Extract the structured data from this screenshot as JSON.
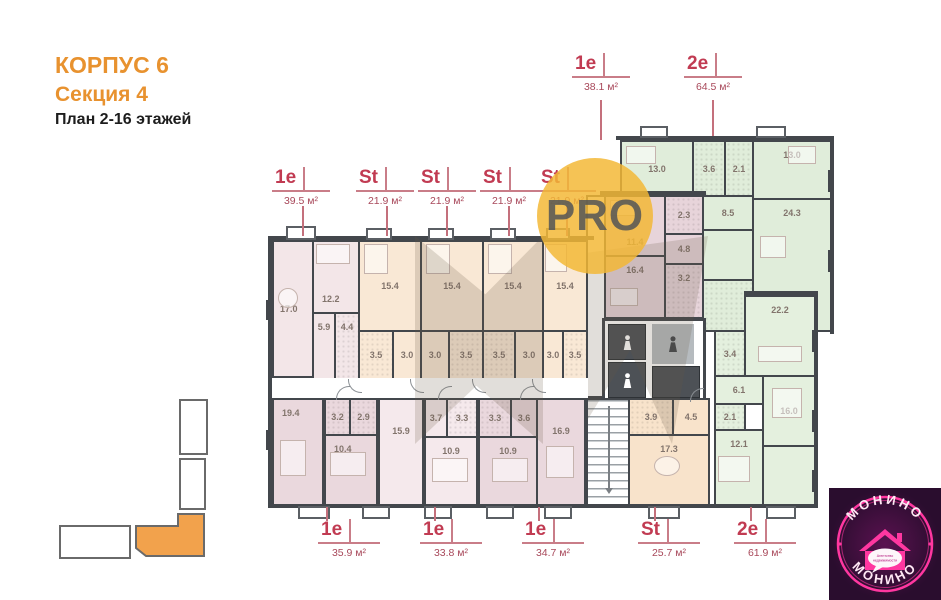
{
  "title": {
    "building": "КОРПУС 6",
    "section": "Секция 4",
    "floors": "План 2-16 этажей"
  },
  "callouts": {
    "top": [
      {
        "type": "1e",
        "area": "38.1 м²"
      },
      {
        "type": "2e",
        "area": "64.5 м²"
      }
    ],
    "upper": [
      {
        "type": "1e",
        "area": "39.5 м²"
      },
      {
        "type": "St",
        "area": "21.9 м²"
      },
      {
        "type": "St",
        "area": "21.9 м²"
      },
      {
        "type": "St",
        "area": "21.9 м²"
      },
      {
        "type": "St",
        "area": "21.9 м²"
      }
    ],
    "bottom": [
      {
        "type": "1e",
        "area": "35.9 м²"
      },
      {
        "type": "1e",
        "area": "33.8 м²"
      },
      {
        "type": "1e",
        "area": "34.7 м²"
      },
      {
        "type": "St",
        "area": "25.7 м²"
      },
      {
        "type": "2e",
        "area": "61.9 м²"
      }
    ]
  },
  "rooms": {
    "apt39": [
      "17.0",
      "12.2",
      "5.9",
      "4.4"
    ],
    "st1": [
      "15.4",
      "3.5",
      "3.0"
    ],
    "st2": [
      "15.4",
      "3.0",
      "3.5"
    ],
    "st3": [
      "15.4",
      "3.5",
      "3.0"
    ],
    "st4": [
      "15.4",
      "3.0",
      "3.5"
    ],
    "apt38": [
      "11.4",
      "2.3",
      "4.8",
      "16.4",
      "3.2"
    ],
    "apt64": [
      "13.0",
      "3.6",
      "2.1",
      "13.0",
      "8.5",
      "24.3"
    ],
    "apt35": [
      "19.4",
      "3.2",
      "2.9",
      "10.4"
    ],
    "apt33": [
      "15.9",
      "3.7",
      "3.3",
      "10.9"
    ],
    "apt34": [
      "3.3",
      "3.6",
      "10.9",
      "16.9"
    ],
    "st25": [
      "3.9",
      "4.5",
      "17.3"
    ],
    "apt61": [
      "22.2",
      "3.4",
      "6.1",
      "2.1",
      "16.0",
      "12.1"
    ]
  },
  "watermark": {
    "label": "PRO"
  },
  "logo": {
    "arc_top": "МОНИНО",
    "arc_bottom": "МОНИНО",
    "bubble_line1": "Агентство",
    "bubble_line2": "недвижимости"
  },
  "colors": {
    "accent_orange": "#e8922f",
    "callout_red": "#c13b52",
    "plan_pink": "#f3e6e8",
    "plan_mauve": "#e7d4da",
    "plan_peach": "#f9e8d5",
    "plan_green": "#e2efdc",
    "logo_pink": "#ff37a0",
    "watermark_orange": "#f3b734"
  }
}
